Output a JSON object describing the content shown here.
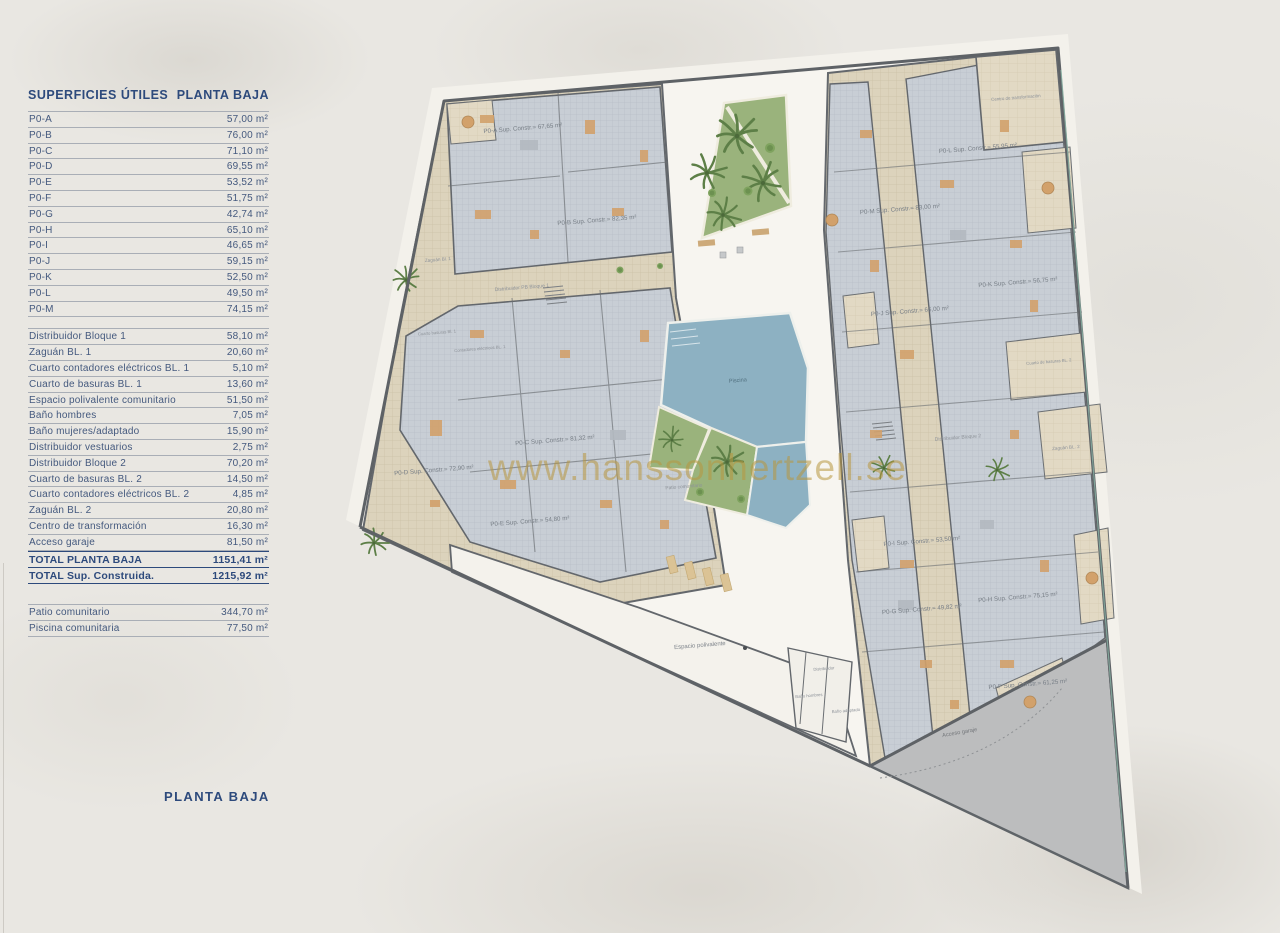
{
  "table": {
    "header": {
      "col1": "SUPERFICIES ÚTILES",
      "col2": "PLANTA BAJA"
    },
    "units": [
      {
        "label": "P0-A",
        "value": "57,00 m²"
      },
      {
        "label": "P0-B",
        "value": "76,00 m²"
      },
      {
        "label": "P0-C",
        "value": "71,10 m²"
      },
      {
        "label": "P0-D",
        "value": "69,55 m²"
      },
      {
        "label": "P0-E",
        "value": "53,52 m²"
      },
      {
        "label": "P0-F",
        "value": "51,75 m²"
      },
      {
        "label": "P0-G",
        "value": "42,74 m²"
      },
      {
        "label": "P0-H",
        "value": "65,10 m²"
      },
      {
        "label": "P0-I",
        "value": "46,65 m²"
      },
      {
        "label": "P0-J",
        "value": "59,15 m²"
      },
      {
        "label": "P0-K",
        "value": "52,50 m²"
      },
      {
        "label": "P0-L",
        "value": "49,50 m²"
      },
      {
        "label": "P0-M",
        "value": "74,15 m²"
      }
    ],
    "commons": [
      {
        "label": "Distribuidor Bloque 1",
        "value": "58,10 m²"
      },
      {
        "label": "Zaguán BL. 1",
        "value": "20,60 m²"
      },
      {
        "label": "Cuarto contadores eléctricos BL. 1",
        "value": "5,10 m²"
      },
      {
        "label": "Cuarto de basuras BL. 1",
        "value": "13,60 m²"
      },
      {
        "label": "Espacio polivalente comunitario",
        "value": "51,50 m²"
      },
      {
        "label": "Baño hombres",
        "value": "7,05 m²"
      },
      {
        "label": "Baño mujeres/adaptado",
        "value": "15,90 m²"
      },
      {
        "label": "Distribuidor vestuarios",
        "value": "2,75 m²"
      },
      {
        "label": "Distribuidor Bloque 2",
        "value": "70,20 m²"
      },
      {
        "label": "Cuarto de basuras BL. 2",
        "value": "14,50 m²"
      },
      {
        "label": "Cuarto contadores eléctricos BL. 2",
        "value": "4,85 m²"
      },
      {
        "label": "Zaguán BL. 2",
        "value": "20,80 m²"
      },
      {
        "label": "Centro de transformación",
        "value": "16,30 m²"
      },
      {
        "label": "Acceso garaje",
        "value": "81,50 m²"
      }
    ],
    "totals": [
      {
        "label": "TOTAL PLANTA BAJA",
        "value": "1151,41 m²"
      },
      {
        "label": "TOTAL Sup. Construida.",
        "value": "1215,92 m²"
      }
    ],
    "outdoor": [
      {
        "label": "Patio comunitario",
        "value": "344,70 m²"
      },
      {
        "label": "Piscina comunitaria",
        "value": "77,50 m²"
      }
    ]
  },
  "footer": {
    "plan_title": "PLANTA BAJA"
  },
  "watermark": "www.hanssonhertzell.se",
  "plan": {
    "labels": {
      "p0a": "P0-A Sup. Constr.= 67,65 m²",
      "p0b": "P0-B Sup. Constr.= 82,35 m²",
      "p0c": "P0-C Sup. Constr.= 81,32 m²",
      "p0d": "P0-D Sup. Constr.= 72,90 m²",
      "p0e": "P0-E Sup. Constr.= 54,80 m²",
      "p0f": "P0-F Sup. Constr.= 61,25 m²",
      "p0g": "P0-G Sup. Constr.= 49,82 m²",
      "p0h": "P0-H Sup. Constr.= 75,15 m²",
      "p0i": "P0-I Sup. Constr.= 53,50 m²",
      "p0j": "P0-J Sup. Constr.= 66,00 m²",
      "p0k": "P0-K Sup. Constr.= 56,75 m²",
      "p0l": "P0-L Sup. Constr.= 55,95 m²",
      "p0m": "P0-M Sup. Constr.= 83,00 m²",
      "piscina": "Piscina",
      "patio": "Patio comunitario",
      "espacio": "Espacio polivalente",
      "distribuidor_b1": "Distribuidor PB Bloque 1",
      "distribuidor_b2": "Distribuidor Bloque 2",
      "zaguan1": "Zaguán Bl. 1",
      "zaguan2": "Zaguán BL. 2",
      "centro": "Centro de transformación",
      "basuras1": "Cuarto basuras Bl. 1",
      "contadores1": "Contadores eléctricos BL. 1",
      "basuras2": "Cuarto de basuras BL. 2",
      "acceso": "Acceso garaje",
      "distribuidor": "Distribuidor",
      "bano_h": "Baño hombres",
      "bano_a": "Baño adaptado"
    }
  }
}
